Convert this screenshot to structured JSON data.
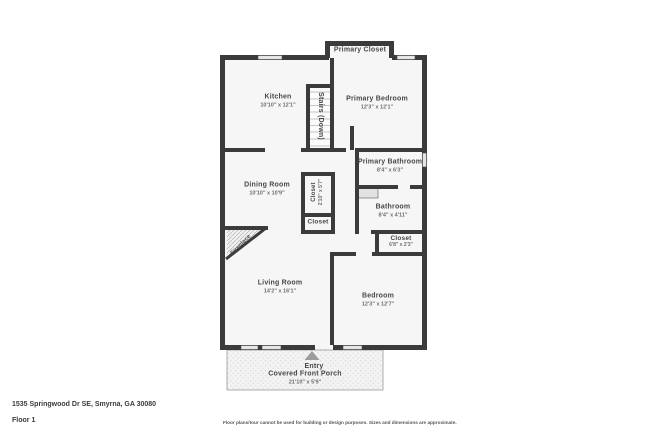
{
  "plan": {
    "rooms": [
      {
        "name": "Primary Closet",
        "dims": ""
      },
      {
        "name": "Kitchen",
        "dims": "10'10\" x 12'1\""
      },
      {
        "name": "Stairs (Down)",
        "dims": ""
      },
      {
        "name": "Primary Bedroom",
        "dims": "12'3\" x 12'1\""
      },
      {
        "name": "Primary Bathroom",
        "dims": "8'4\" x 6'3\""
      },
      {
        "name": "Dining Room",
        "dims": "10'10\" x 10'9\""
      },
      {
        "name": "Closet",
        "dims": "2'10\" x 5'7\""
      },
      {
        "name": "Closet",
        "dims": ""
      },
      {
        "name": "Bathroom",
        "dims": "8'4\" x 4'11\""
      },
      {
        "name": "Closet",
        "dims": "6'8\" x 2'3\""
      },
      {
        "name": "Fireplace",
        "dims": ""
      },
      {
        "name": "Living Room",
        "dims": "14'2\" x 16'1\""
      },
      {
        "name": "Bedroom",
        "dims": "12'3\" x 12'7\""
      },
      {
        "name": "Entry",
        "dims": ""
      },
      {
        "name": "Covered Front Porch",
        "dims": "21'10\" x 5'9\""
      }
    ],
    "colors": {
      "wall": "#3B3B3B",
      "floor": "#F6F6F6",
      "porch": "#F3F3F3",
      "window": "#E6E6E6",
      "entry_arrow": "#9C9C9C"
    }
  },
  "footer": {
    "address": "1535 Springwood Dr SE, Smyrna, GA 30080",
    "floor_label": "Floor 1",
    "disclaimer": "Floor plans/tour cannot be used for building or design purposes. Sizes and dimensions are approximate."
  }
}
